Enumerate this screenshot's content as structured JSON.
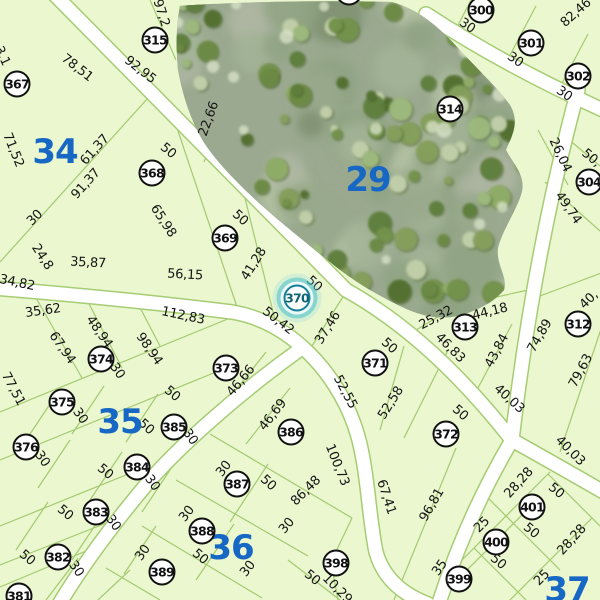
{
  "map": {
    "selected_parcel": "370",
    "colors": {
      "parcel_fill": "#EAF7CF",
      "boundary_line": "#A3CA70",
      "road_fill": "#FFFFFF",
      "marker_border": "#111111",
      "marker_fill": "#FFFFFF",
      "block_label_blue": "#1668C4",
      "highlight_teal": "#2FAFC2",
      "dimension_text": "#151515"
    },
    "block_labels": [
      {
        "text": "34",
        "x": 55,
        "y": 152
      },
      {
        "text": "29",
        "x": 368,
        "y": 180
      },
      {
        "text": "35",
        "x": 120,
        "y": 422
      },
      {
        "text": "36",
        "x": 231,
        "y": 548
      },
      {
        "text": "37",
        "x": 567,
        "y": 590
      }
    ],
    "parcel_markers": [
      {
        "label": "300",
        "x": 481,
        "y": 10
      },
      {
        "label": "301",
        "x": 531,
        "y": 43
      },
      {
        "label": "302",
        "x": 578,
        "y": 76
      },
      {
        "label": "304",
        "x": 589,
        "y": 182
      },
      {
        "label": "312",
        "x": 578,
        "y": 324
      },
      {
        "label": "313",
        "x": 465,
        "y": 327
      },
      {
        "label": "314",
        "x": 450,
        "y": 109
      },
      {
        "label": "315",
        "x": 155,
        "y": 40
      },
      {
        "label": "367",
        "x": 17,
        "y": 84
      },
      {
        "label": "368",
        "x": 152,
        "y": 173
      },
      {
        "label": "369",
        "x": 225,
        "y": 238
      },
      {
        "label": "370",
        "x": 297,
        "y": 298,
        "highlighted": true
      },
      {
        "label": "371",
        "x": 375,
        "y": 363
      },
      {
        "label": "372",
        "x": 446,
        "y": 434
      },
      {
        "label": "373",
        "x": 226,
        "y": 368
      },
      {
        "label": "374",
        "x": 101,
        "y": 359
      },
      {
        "label": "375",
        "x": 62,
        "y": 402
      },
      {
        "label": "376",
        "x": 26,
        "y": 447
      },
      {
        "label": "381",
        "x": 19,
        "y": 596
      },
      {
        "label": "382",
        "x": 58,
        "y": 557
      },
      {
        "label": "383",
        "x": 96,
        "y": 512
      },
      {
        "label": "384",
        "x": 137,
        "y": 467
      },
      {
        "label": "385",
        "x": 174,
        "y": 427
      },
      {
        "label": "386",
        "x": 291,
        "y": 432
      },
      {
        "label": "387",
        "x": 237,
        "y": 484
      },
      {
        "label": "388",
        "x": 202,
        "y": 531
      },
      {
        "label": "389",
        "x": 162,
        "y": 572
      },
      {
        "label": "398",
        "x": 336,
        "y": 563
      },
      {
        "label": "399",
        "x": 459,
        "y": 579
      },
      {
        "label": "400",
        "x": 496,
        "y": 542
      },
      {
        "label": "401",
        "x": 532,
        "y": 507
      },
      {
        "label": "",
        "x": 349,
        "y": -8
      }
    ],
    "dimension_labels": [
      {
        "text": "97,2",
        "x": 161,
        "y": 13,
        "rot": 72
      },
      {
        "text": "92,95",
        "x": 140,
        "y": 70,
        "rot": 38
      },
      {
        "text": "78,51",
        "x": 77,
        "y": 68,
        "rot": 38
      },
      {
        "text": "3,1",
        "x": 2,
        "y": 56,
        "rot": 65
      },
      {
        "text": "82,46",
        "x": 576,
        "y": 13,
        "rot": -42
      },
      {
        "text": "30",
        "x": 467,
        "y": 26,
        "rot": 35
      },
      {
        "text": "30",
        "x": 515,
        "y": 60,
        "rot": 35
      },
      {
        "text": "30",
        "x": 564,
        "y": 94,
        "rot": 35
      },
      {
        "text": "71,52",
        "x": 13,
        "y": 150,
        "rot": 68
      },
      {
        "text": "61,37",
        "x": 95,
        "y": 150,
        "rot": -48
      },
      {
        "text": "91,37",
        "x": 86,
        "y": 184,
        "rot": -48
      },
      {
        "text": "50",
        "x": 168,
        "y": 151,
        "rot": 40
      },
      {
        "text": "22,66",
        "x": 209,
        "y": 119,
        "rot": -70
      },
      {
        "text": "65,98",
        "x": 163,
        "y": 221,
        "rot": 57
      },
      {
        "text": "50",
        "x": 240,
        "y": 218,
        "rot": 42
      },
      {
        "text": "30",
        "x": 35,
        "y": 218,
        "rot": -45
      },
      {
        "text": "24,8",
        "x": 42,
        "y": 257,
        "rot": 57
      },
      {
        "text": "35,87",
        "x": 88,
        "y": 263,
        "rot": 3
      },
      {
        "text": "34,82",
        "x": 17,
        "y": 283,
        "rot": 12
      },
      {
        "text": "56,15",
        "x": 185,
        "y": 275,
        "rot": 3
      },
      {
        "text": "41,28",
        "x": 254,
        "y": 264,
        "rot": -58
      },
      {
        "text": "50",
        "x": 314,
        "y": 284,
        "rot": 42
      },
      {
        "text": "26,04",
        "x": 560,
        "y": 155,
        "rot": 65
      },
      {
        "text": "50,",
        "x": 591,
        "y": 158,
        "rot": 40
      },
      {
        "text": "49,74",
        "x": 568,
        "y": 208,
        "rot": 55
      },
      {
        "text": "25,32",
        "x": 436,
        "y": 318,
        "rot": -28
      },
      {
        "text": "44,18",
        "x": 490,
        "y": 312,
        "rot": -14
      },
      {
        "text": "46,83",
        "x": 450,
        "y": 348,
        "rot": 45
      },
      {
        "text": "43,84",
        "x": 497,
        "y": 351,
        "rot": -62
      },
      {
        "text": "74,89",
        "x": 540,
        "y": 336,
        "rot": -60
      },
      {
        "text": "40,",
        "x": 589,
        "y": 300,
        "rot": -45
      },
      {
        "text": "79,63",
        "x": 581,
        "y": 371,
        "rot": -62
      },
      {
        "text": "35,62",
        "x": 43,
        "y": 311,
        "rot": -8
      },
      {
        "text": "112,83",
        "x": 183,
        "y": 316,
        "rot": 12
      },
      {
        "text": "50,42",
        "x": 278,
        "y": 321,
        "rot": 38
      },
      {
        "text": "37,46",
        "x": 328,
        "y": 328,
        "rot": -58
      },
      {
        "text": "50",
        "x": 389,
        "y": 346,
        "rot": 42
      },
      {
        "text": "48,94",
        "x": 99,
        "y": 332,
        "rot": 55
      },
      {
        "text": "67,94",
        "x": 62,
        "y": 348,
        "rot": 55
      },
      {
        "text": "98,94",
        "x": 149,
        "y": 349,
        "rot": 55
      },
      {
        "text": "30",
        "x": 117,
        "y": 371,
        "rot": 55
      },
      {
        "text": "77,51",
        "x": 13,
        "y": 389,
        "rot": 62
      },
      {
        "text": "46,66",
        "x": 241,
        "y": 381,
        "rot": -50
      },
      {
        "text": "52,55",
        "x": 345,
        "y": 392,
        "rot": 62
      },
      {
        "text": "52,58",
        "x": 391,
        "y": 403,
        "rot": -58
      },
      {
        "text": "50",
        "x": 460,
        "y": 413,
        "rot": 42
      },
      {
        "text": "96,81",
        "x": 432,
        "y": 505,
        "rot": -60
      },
      {
        "text": "40,03",
        "x": 509,
        "y": 399,
        "rot": 42
      },
      {
        "text": "40,03",
        "x": 570,
        "y": 451,
        "rot": 45
      },
      {
        "text": "30",
        "x": 80,
        "y": 416,
        "rot": 55
      },
      {
        "text": "50",
        "x": 172,
        "y": 394,
        "rot": 40
      },
      {
        "text": "50",
        "x": 146,
        "y": 427,
        "rot": 42
      },
      {
        "text": "30",
        "x": 190,
        "y": 437,
        "rot": 55
      },
      {
        "text": "30",
        "x": 42,
        "y": 459,
        "rot": 55
      },
      {
        "text": "50",
        "x": 105,
        "y": 472,
        "rot": 40
      },
      {
        "text": "30",
        "x": 152,
        "y": 483,
        "rot": 55
      },
      {
        "text": "50",
        "x": 65,
        "y": 513,
        "rot": 40
      },
      {
        "text": "30",
        "x": 113,
        "y": 523,
        "rot": 55
      },
      {
        "text": "50",
        "x": 27,
        "y": 558,
        "rot": 40
      },
      {
        "text": "30",
        "x": 76,
        "y": 569,
        "rot": 55
      },
      {
        "text": "46,69",
        "x": 273,
        "y": 415,
        "rot": -52
      },
      {
        "text": "100,73",
        "x": 337,
        "y": 465,
        "rot": 68
      },
      {
        "text": "86,48",
        "x": 306,
        "y": 491,
        "rot": -45
      },
      {
        "text": "67,41",
        "x": 386,
        "y": 497,
        "rot": 72
      },
      {
        "text": "30",
        "x": 224,
        "y": 469,
        "rot": -52
      },
      {
        "text": "50",
        "x": 268,
        "y": 483,
        "rot": 42
      },
      {
        "text": "30",
        "x": 187,
        "y": 514,
        "rot": -52
      },
      {
        "text": "30",
        "x": 287,
        "y": 526,
        "rot": -50
      },
      {
        "text": "50",
        "x": 200,
        "y": 557,
        "rot": 40
      },
      {
        "text": "30",
        "x": 143,
        "y": 553,
        "rot": -55
      },
      {
        "text": "30",
        "x": 248,
        "y": 569,
        "rot": -52
      },
      {
        "text": "50",
        "x": 312,
        "y": 578,
        "rot": 40
      },
      {
        "text": "10,29",
        "x": 337,
        "y": 589,
        "rot": 45
      },
      {
        "text": "28,28",
        "x": 519,
        "y": 483,
        "rot": -48
      },
      {
        "text": "50",
        "x": 556,
        "y": 491,
        "rot": 40
      },
      {
        "text": "50",
        "x": 531,
        "y": 531,
        "rot": 40
      },
      {
        "text": "28,28",
        "x": 572,
        "y": 540,
        "rot": -48
      },
      {
        "text": "25",
        "x": 482,
        "y": 525,
        "rot": -45
      },
      {
        "text": "50",
        "x": 498,
        "y": 562,
        "rot": 40
      },
      {
        "text": "35",
        "x": 440,
        "y": 568,
        "rot": -55
      },
      {
        "text": "25",
        "x": 542,
        "y": 578,
        "rot": -45
      }
    ]
  }
}
